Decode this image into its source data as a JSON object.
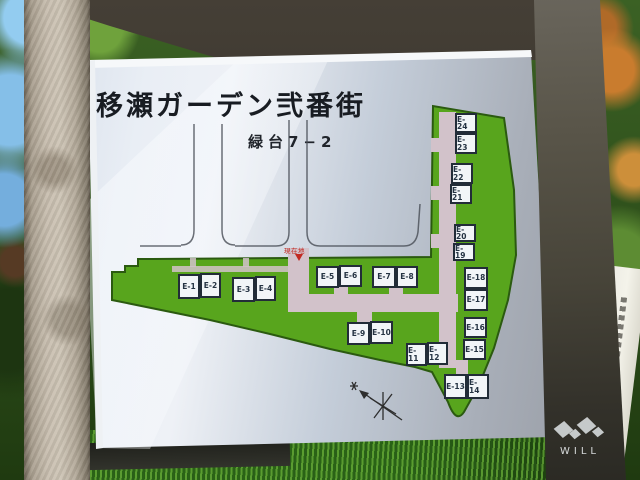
{
  "sign": {
    "title": "移瀬ガーデン弐番街",
    "subtitle": "緑台7−2",
    "you_are_here": "現在地",
    "buildings": [
      "E-1",
      "E-2",
      "E-3",
      "E-4",
      "E-5",
      "E-6",
      "E-7",
      "E-8",
      "E-9",
      "E-10",
      "E-11",
      "E-12",
      "E-13",
      "E-14",
      "E-15",
      "E-16",
      "E-17",
      "E-18",
      "E-19",
      "E-20",
      "E-21",
      "E-22",
      "E-23",
      "E-24"
    ]
  },
  "watermark": {
    "text": "WILL"
  },
  "colors": {
    "estate_green": "#58a51d",
    "road_pink": "#d2c2ca",
    "marker_red": "#c22a22",
    "panel_light": "#e9eef5",
    "panel_dark": "#969aa2",
    "building_border": "#222c38"
  }
}
